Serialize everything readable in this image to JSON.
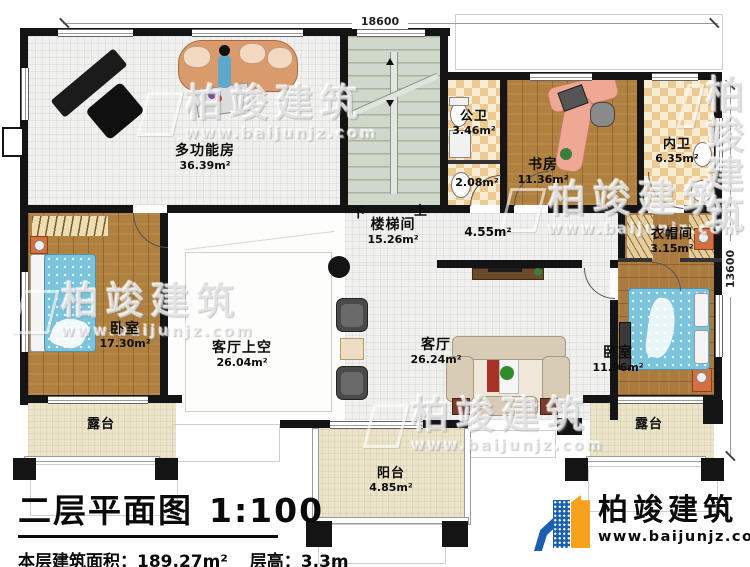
{
  "dimensions": {
    "top": "18600",
    "right": "13600"
  },
  "stairs": {
    "down": "下",
    "up": "上"
  },
  "rooms": [
    {
      "name": "多功能房",
      "area": "36.39m²"
    },
    {
      "name": "公卫",
      "area": "3.46m²"
    },
    {
      "name": "",
      "area": "2.08m²"
    },
    {
      "name": "书房",
      "area": "11.36m²"
    },
    {
      "name": "内卫",
      "area": "6.35m²"
    },
    {
      "name": "楼梯间",
      "area": "15.26m²"
    },
    {
      "name": "",
      "area": "4.55m²"
    },
    {
      "name": "衣帽间",
      "area": "3.15m²"
    },
    {
      "name": "卧室",
      "area": "17.30m²"
    },
    {
      "name": "客厅上空",
      "area": "26.04m²"
    },
    {
      "name": "客厅",
      "area": "26.24m²"
    },
    {
      "name": "卧室",
      "area": "11.96m²"
    },
    {
      "name": "露台",
      "area": ""
    },
    {
      "name": "露台",
      "area": ""
    },
    {
      "name": "阳台",
      "area": "4.85m²"
    }
  ],
  "title_block": {
    "title": "二层平面图",
    "scale": "1:100",
    "area_label": "本层建筑面积：",
    "area_value": "189.27m²",
    "height_label": "层高：",
    "height_value": "3.3m"
  },
  "brand": {
    "name": "柏竣建筑",
    "url": "www.baijunjz.com"
  },
  "watermark": {
    "name": "柏竣建筑",
    "url": "www.baijunjz.com"
  },
  "colors": {
    "brand_blue": "#1a5fb0",
    "brand_orange": "#f6a21c",
    "wall": "#141414"
  }
}
